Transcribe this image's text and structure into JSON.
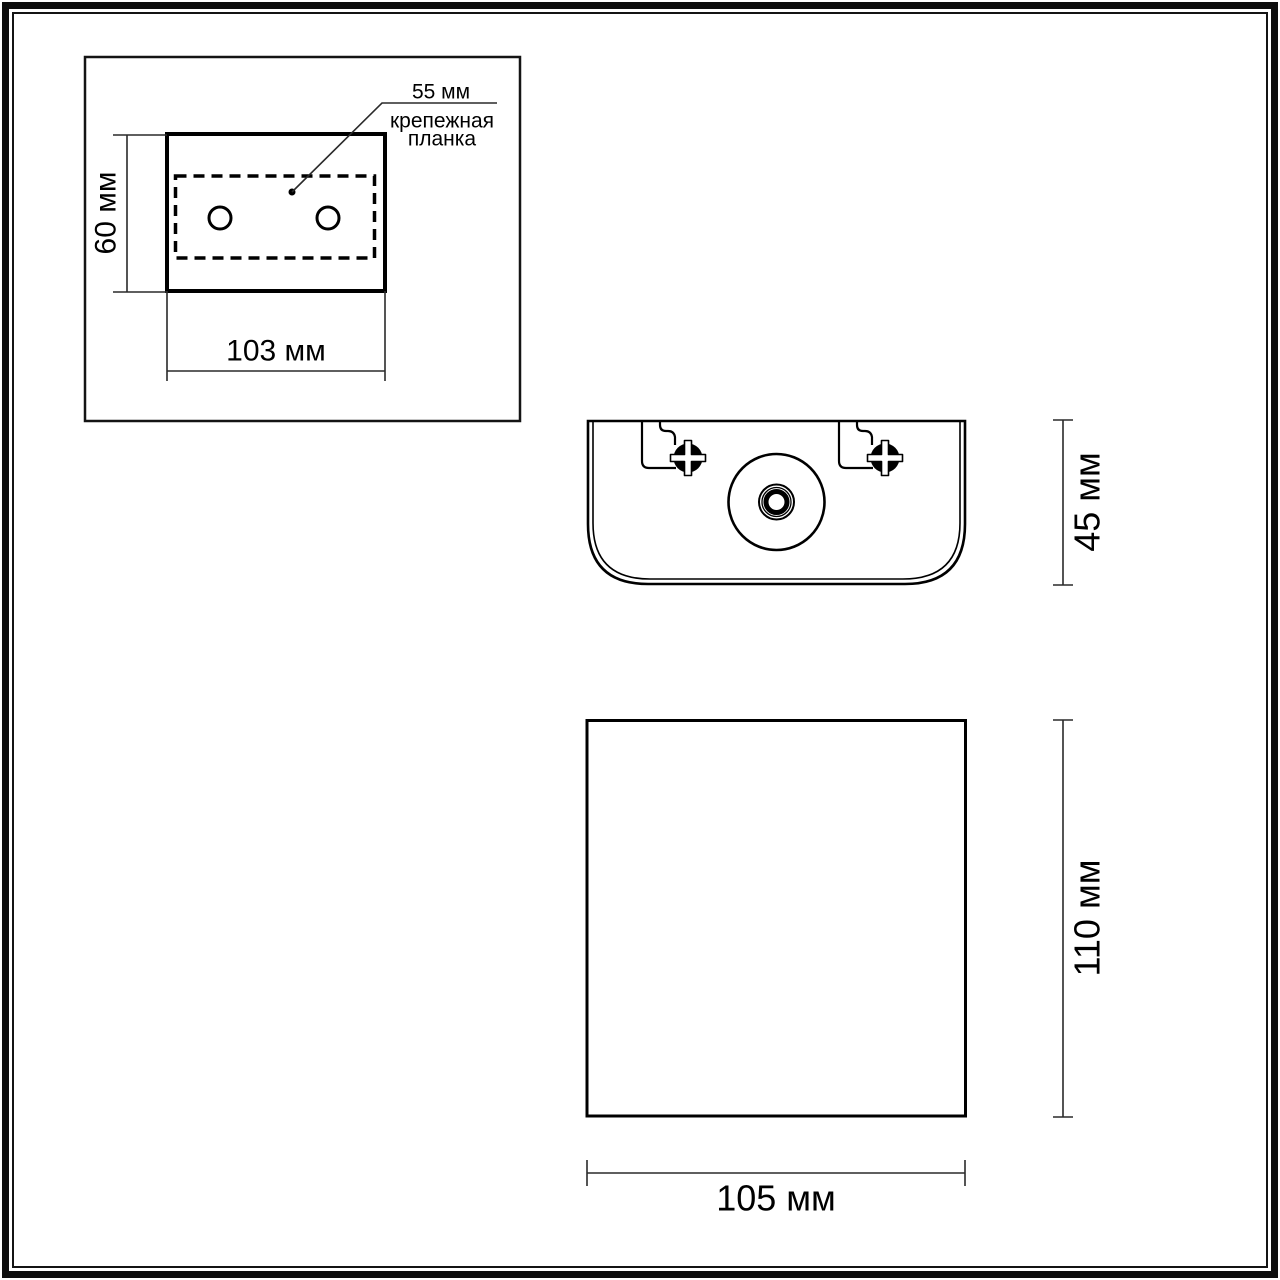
{
  "page": {
    "background": "#ffffff",
    "line_color": "#000000",
    "type_note": "technical dimension drawing of a wall luminaire"
  },
  "mounting_template": {
    "plate_width_label": "55 мм",
    "plate_note_line1": "крепежная",
    "plate_note_line2": "планка",
    "height_label": "60 мм",
    "width_label": "103 мм"
  },
  "top_view": {
    "depth_label": "45 мм"
  },
  "front_view": {
    "height_label": "110 мм",
    "width_label": "105 мм"
  },
  "dimensions_mm": {
    "template_width": 103,
    "template_height": 60,
    "plate_width": 55,
    "body_depth": 45,
    "body_height": 110,
    "body_width": 105
  }
}
